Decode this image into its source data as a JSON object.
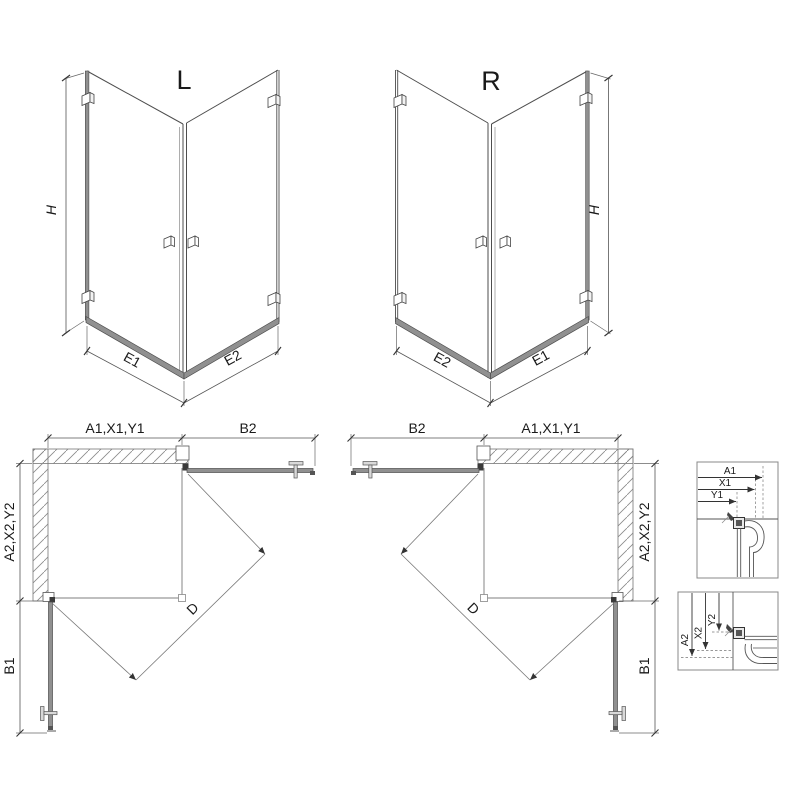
{
  "colors": {
    "background": "#ffffff",
    "line_dark": "#3f3f3f",
    "line_mid": "#777777",
    "profile_gray": "#909090",
    "handle_gray": "#d9d9d9",
    "text": "#1a1a1a"
  },
  "iso_l": {
    "label": "L",
    "dim_height": "H",
    "dim_base_left": "E1",
    "dim_base_right": "E2"
  },
  "iso_r": {
    "label": "R",
    "dim_height": "H",
    "dim_base_left": "E2",
    "dim_base_right": "E1"
  },
  "plan_l": {
    "dim_width": "A1,X1,Y1",
    "dim_door_b2": "B2",
    "dim_depth": "A2,X2,Y2",
    "dim_door_b1": "B1",
    "dim_diagonal": "D"
  },
  "plan_r": {
    "dim_door_b2": "B2",
    "dim_width": "A1,X1,Y1",
    "dim_depth": "A2,X2,Y2",
    "dim_door_b1": "B1",
    "dim_diagonal": "D"
  },
  "detail_top": {
    "dim_a": "A1",
    "dim_x": "X1",
    "dim_y": "Y1"
  },
  "detail_bottom": {
    "dim_a": "A2",
    "dim_x": "X2",
    "dim_y": "Y2"
  }
}
